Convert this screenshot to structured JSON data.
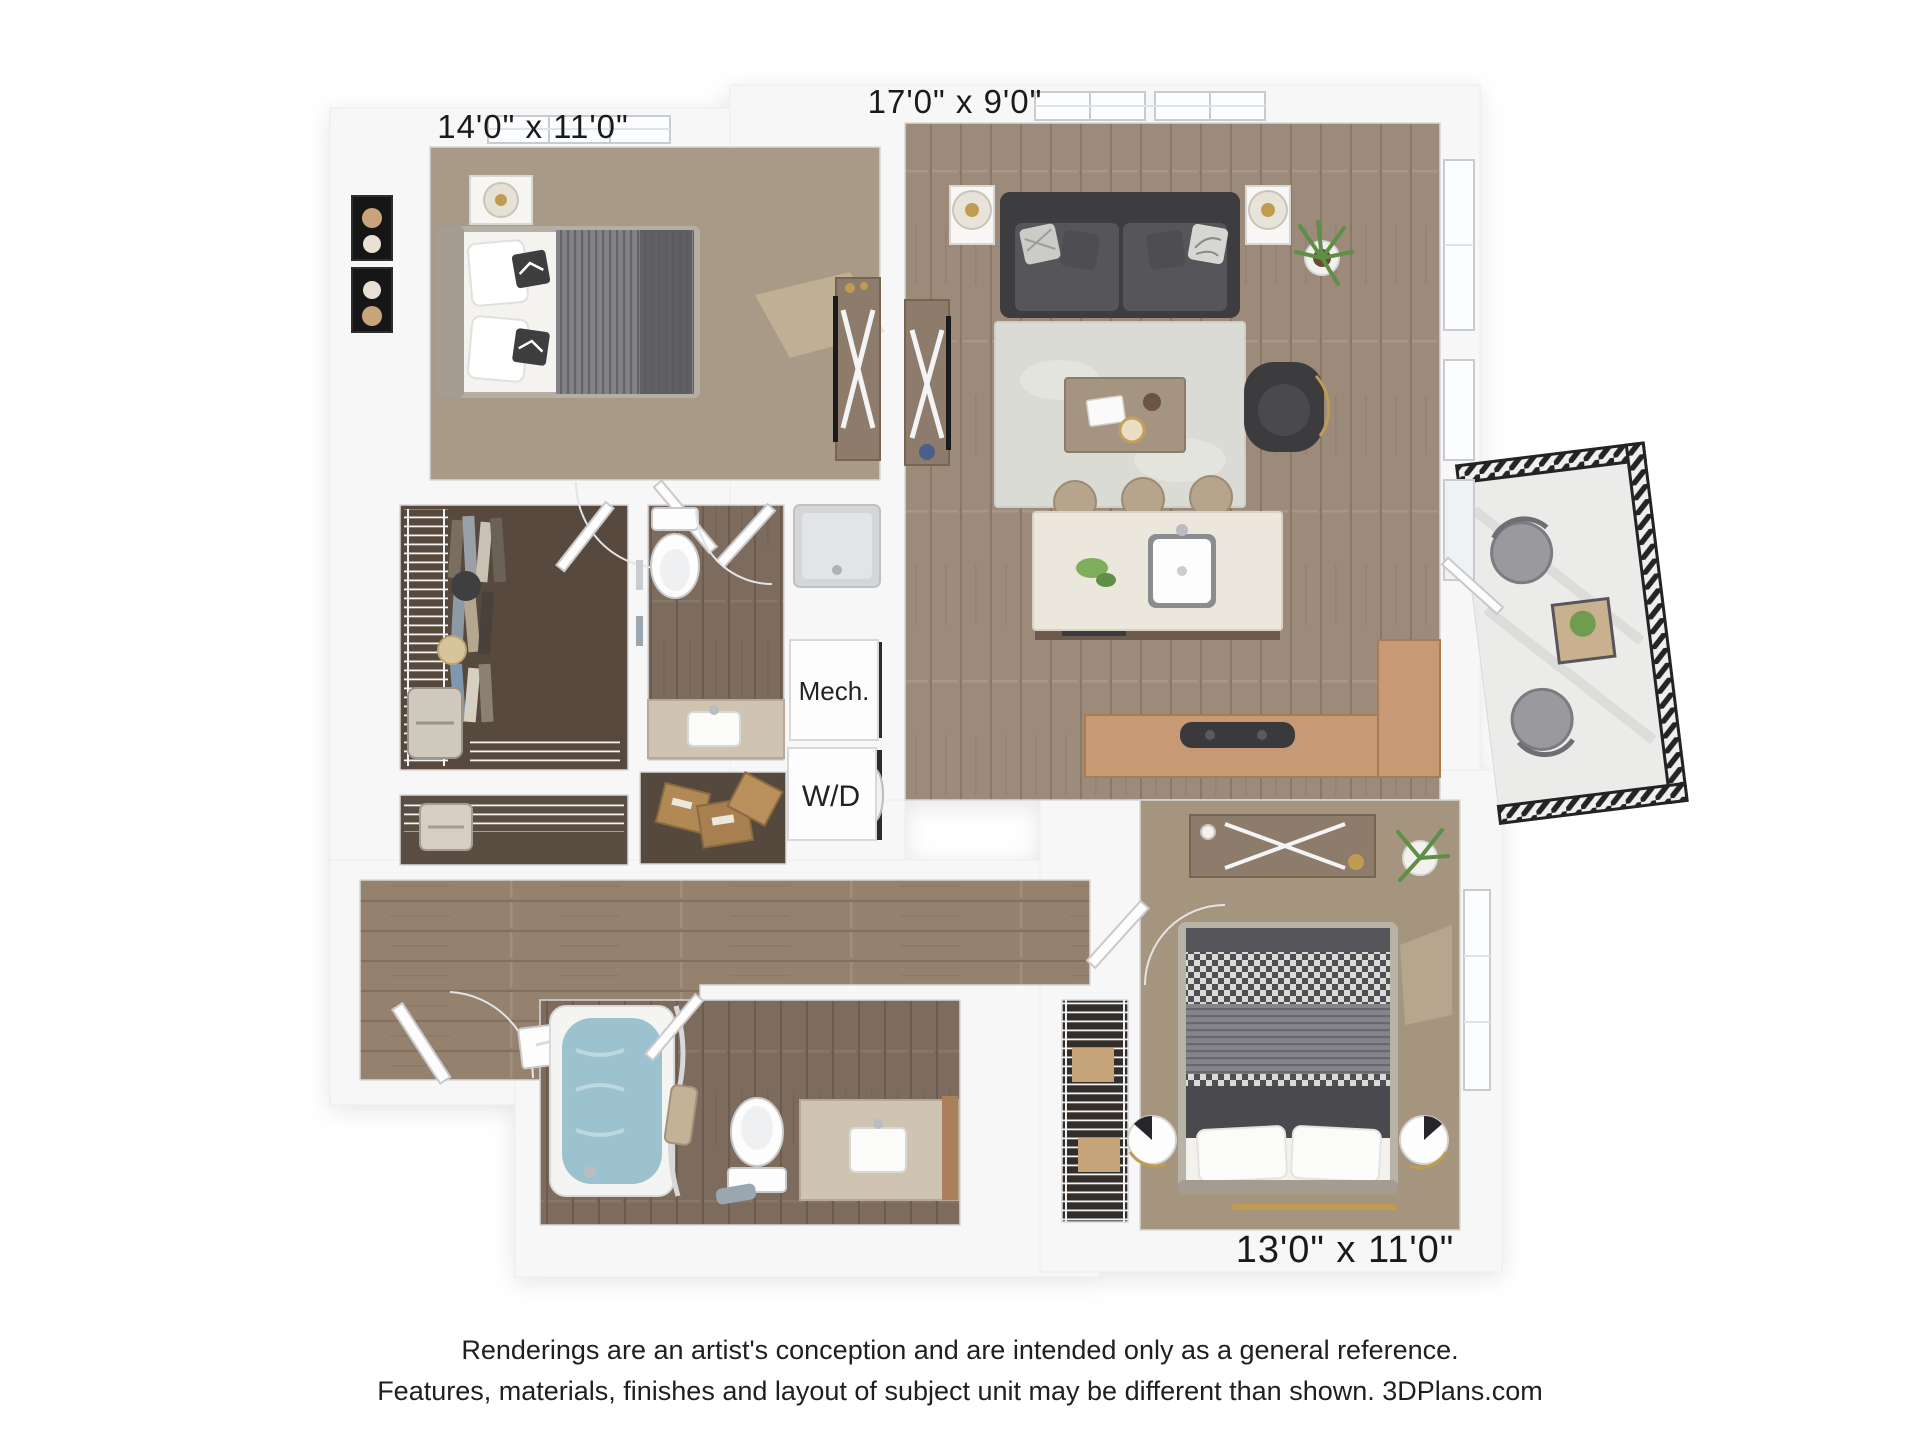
{
  "page": {
    "background": "#ffffff"
  },
  "floorplan": {
    "dimension_labels": {
      "bedroom1": "14'0\" x 11'0\"",
      "living": "17'0\" x 9'0\"",
      "bedroom2": "13'0\" x 11'0\""
    },
    "utility_labels": {
      "mech": "Mech.",
      "washer_dryer": "W/D"
    },
    "colors": {
      "wall": "#f7f7f8",
      "wood_floor": "#9c8a7a",
      "wood_floor_dark": "#7d6c5e",
      "carpet": "#a89a86",
      "closet_carpet": "#57493d",
      "kitchen_counter": "#c79974",
      "island_top": "#ece7dd",
      "rug": "#dbdbd5",
      "sofa": "#4a4a4c",
      "balcony_railing": "#232325",
      "tub_water": "#9dc2cf",
      "label_text": "#1a1a1a"
    }
  },
  "footer": {
    "line1": "Renderings are an artist's conception and are intended only as a general reference.",
    "line2": "Features, materials, finishes and layout of subject unit may be different than shown. 3DPlans.com"
  }
}
